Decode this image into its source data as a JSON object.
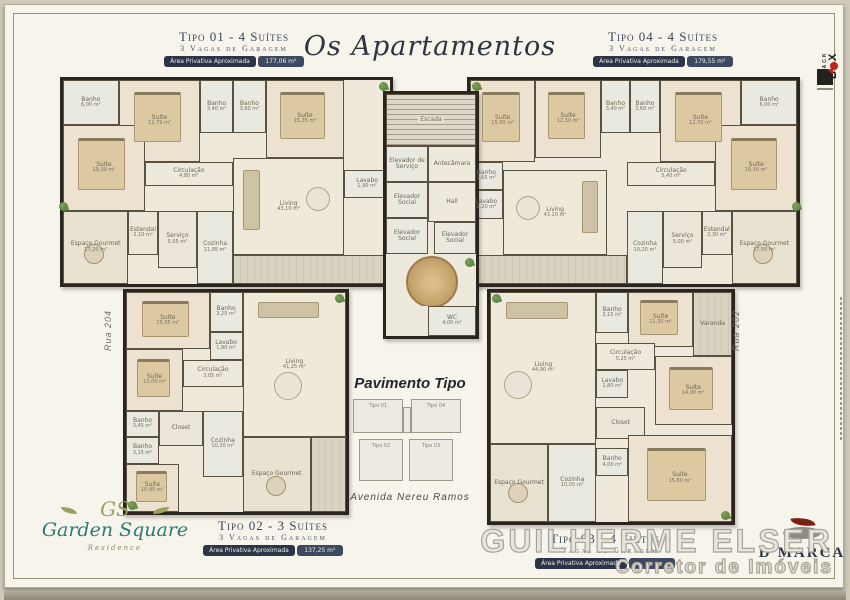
{
  "title": "Os Apartamentos",
  "center": {
    "pavimento_title": "Pavimento Tipo",
    "avenue_label": "Avenida Nereu Ramos",
    "keyplan_labels": [
      "Tipo 01",
      "Tipo 04",
      "Tipo 02",
      "Tipo 03"
    ]
  },
  "streets": {
    "left": "Rua 204",
    "right": "Rua 202"
  },
  "plans": {
    "tipo01": {
      "header": {
        "title": "Tipo 01 - 4 Suítes",
        "subtitle": "3 Vagas de Garagem",
        "area_label": "Área Privativa Aproximada",
        "area_value": "177,06 m²"
      },
      "rooms": {
        "banho_master": {
          "name": "Banho",
          "area": "6,00 m²"
        },
        "suite2": {
          "name": "Suíte",
          "area": "12,79 m²"
        },
        "banho2": {
          "name": "Banho",
          "area": "3,40 m²"
        },
        "banho3": {
          "name": "Banho",
          "area": "3,60 m²"
        },
        "suite3": {
          "name": "Suíte",
          "area": "15,35 m²"
        },
        "suite_master": {
          "name": "Suíte",
          "area": "19,30 m²"
        },
        "circulacao": {
          "name": "Circulação",
          "area": "4,80 m²"
        },
        "living": {
          "name": "Living",
          "area": "43,10 m²"
        },
        "lavabo": {
          "name": "Lavabo",
          "area": "1,90 m²"
        },
        "gourmet": {
          "name": "Espaço Gourmet",
          "area": "17,20 m²"
        },
        "estendal": {
          "name": "Estendal",
          "area": "2,10 m²"
        },
        "servico": {
          "name": "Serviço",
          "area": "5,05 m²"
        },
        "cozinha": {
          "name": "Cozinha",
          "area": "11,95 m²"
        }
      }
    },
    "tipo04": {
      "header": {
        "title": "Tipo 04 - 4 Suítes",
        "subtitle": "3 Vagas de Garagem",
        "area_label": "Área Privativa Aproximada",
        "area_value": "179,55 m²"
      },
      "rooms": {
        "suite1": {
          "name": "Suíte",
          "area": "15,50 m²"
        },
        "suite2": {
          "name": "Suíte",
          "area": "12,30 m²"
        },
        "banho2": {
          "name": "Banho",
          "area": "3,40 m²"
        },
        "banho3": {
          "name": "Banho",
          "area": "3,60 m²"
        },
        "suite3": {
          "name": "Suíte",
          "area": "12,70 m²"
        },
        "banho_master": {
          "name": "Banho",
          "area": "6,00 m²"
        },
        "suite_master": {
          "name": "Suíte",
          "area": "19,30 m²"
        },
        "banho4": {
          "name": "Banho",
          "area": "3,65 m²"
        },
        "circulacao": {
          "name": "Circulação",
          "area": "5,40 m²"
        },
        "lavabo": {
          "name": "Lavabo",
          "area": "2,20 m²"
        },
        "living": {
          "name": "Living",
          "area": "43,10 m²"
        },
        "cozinha": {
          "name": "Cozinha",
          "area": "10,20 m²"
        },
        "servico": {
          "name": "Serviço",
          "area": "5,00 m²"
        },
        "estendal": {
          "name": "Estendal",
          "area": "2,30 m²"
        },
        "gourmet": {
          "name": "Espaço Gourmet",
          "area": "17,50 m²"
        }
      }
    },
    "tipo02": {
      "header": {
        "title": "Tipo 02 - 3 Suítes",
        "subtitle": "3 Vagas de Garagem",
        "area_label": "Área Privativa Aproximada",
        "area_value": "137,25 m²"
      },
      "rooms": {
        "suite1": {
          "name": "Suíte",
          "area": "15,35 m²"
        },
        "banho1": {
          "name": "Banho",
          "area": "3,25 m²"
        },
        "lavabo": {
          "name": "Lavabo",
          "area": "1,90 m²"
        },
        "living": {
          "name": "Living",
          "area": "41,25 m²"
        },
        "suite2": {
          "name": "Suíte",
          "area": "13,00 m²"
        },
        "circulacao": {
          "name": "Circulação",
          "area": "3,05 m²"
        },
        "banho2": {
          "name": "Banho",
          "area": "3,45 m²"
        },
        "closet": "Closet",
        "banho3": {
          "name": "Banho",
          "area": "3,15 m²"
        },
        "suite3": {
          "name": "Suíte",
          "area": "10,95 m²"
        },
        "cozinha": {
          "name": "Cozinha",
          "area": "10,20 m²"
        },
        "gourmet": {
          "name": "Espaço Gourmet",
          "area": ""
        },
        "varanda": "Varanda"
      }
    },
    "tipo03": {
      "header": {
        "title": "Tipo 03 - 4 Suítes",
        "subtitle": "4 Vagas de Garagem",
        "area_label": "Área Privativa Aproximada",
        "area_value": ""
      },
      "rooms": {
        "living": {
          "name": "Living",
          "area": "44,90 m²"
        },
        "banho1": {
          "name": "Banho",
          "area": "3,15 m²"
        },
        "suite1": {
          "name": "Suíte",
          "area": "11,30 m²"
        },
        "varanda": "Varanda",
        "circulacao": {
          "name": "Circulação",
          "area": "5,25 m²"
        },
        "lavabo": {
          "name": "Lavabo",
          "area": "1,80 m²"
        },
        "suite2": {
          "name": "Suíte",
          "area": "14,00 m²"
        },
        "closet": "Closet",
        "gourmet": {
          "name": "Espaço Gourmet",
          "area": ""
        },
        "cozinha": {
          "name": "Cozinha",
          "area": "10,05 m²"
        },
        "banho2": {
          "name": "Banho",
          "area": "4,00 m²"
        },
        "suite3": {
          "name": "Suíte",
          "area": "15,60 m²"
        }
      }
    },
    "core": {
      "escada": "Escada",
      "elevador_servico": "Elevador de Serviço",
      "antecamara": "Antecâmara",
      "elevador_social": "Elevador Social",
      "hall": "Hall",
      "wc": {
        "name": "WC",
        "area": "4,00 m²"
      }
    }
  },
  "logos": {
    "garden": {
      "monogram": "GS",
      "name": "Garden Square",
      "sub": "Residence"
    },
    "blackbox": {
      "line1": "BLACK",
      "b": "B",
      "x": "X"
    },
    "dmarca": {
      "name": "D'MARCA"
    }
  },
  "watermark": {
    "line1": "GUILHERME ELSER",
    "line2": "Corretor de Imóveis"
  },
  "colors": {
    "navy": "#2c3547",
    "teal": "#2e7a71",
    "red": "#c0231c",
    "olive": "#8a8c5a",
    "wall": "#2b251f"
  }
}
